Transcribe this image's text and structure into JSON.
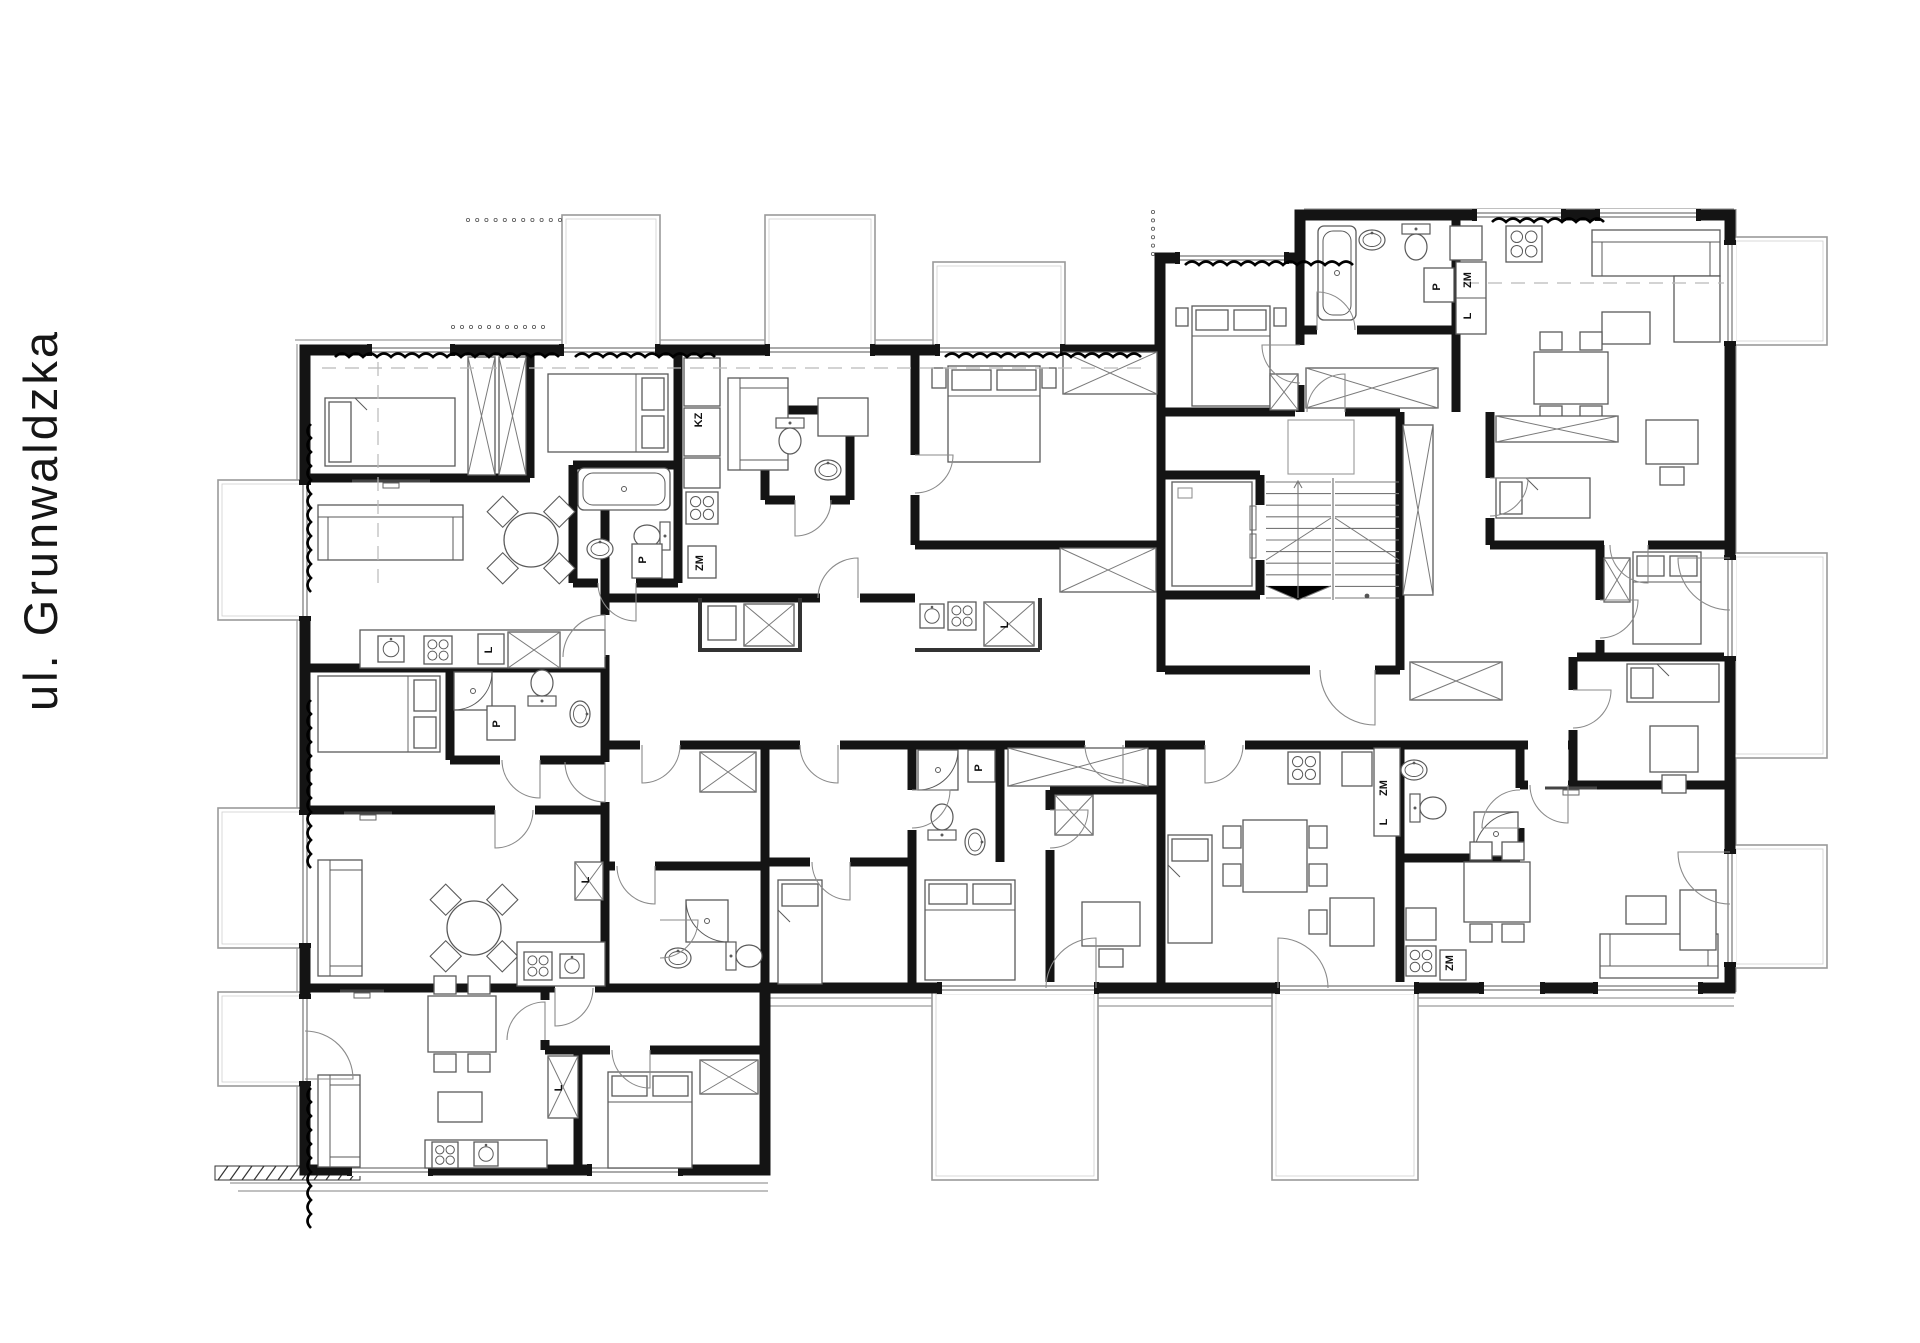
{
  "title": {
    "street_label": "ul. Grunwaldzka"
  },
  "plan": {
    "type": "architectural-floor-plan",
    "appliance_labels": [
      {
        "text": "P",
        "x": 646,
        "y": 560
      },
      {
        "text": "P",
        "x": 500,
        "y": 724
      },
      {
        "text": "P",
        "x": 982,
        "y": 768
      },
      {
        "text": "P",
        "x": 1440,
        "y": 287
      },
      {
        "text": "ZM",
        "x": 703,
        "y": 563
      },
      {
        "text": "ZM",
        "x": 1387,
        "y": 788
      },
      {
        "text": "ZM",
        "x": 1471,
        "y": 280
      },
      {
        "text": "ZM",
        "x": 1453,
        "y": 963
      },
      {
        "text": "L",
        "x": 492,
        "y": 650
      },
      {
        "text": "L",
        "x": 1008,
        "y": 625
      },
      {
        "text": "L",
        "x": 589,
        "y": 880
      },
      {
        "text": "L",
        "x": 562,
        "y": 1088
      },
      {
        "text": "L",
        "x": 1387,
        "y": 822
      },
      {
        "text": "L",
        "x": 1471,
        "y": 316
      },
      {
        "text": "KZ",
        "x": 702,
        "y": 420
      }
    ],
    "colors": {
      "background": "#ffffff",
      "walls": "#141414",
      "furniture": "#5a5a5a",
      "thin_lines": "#9b9b9b",
      "text": "#161616"
    }
  }
}
